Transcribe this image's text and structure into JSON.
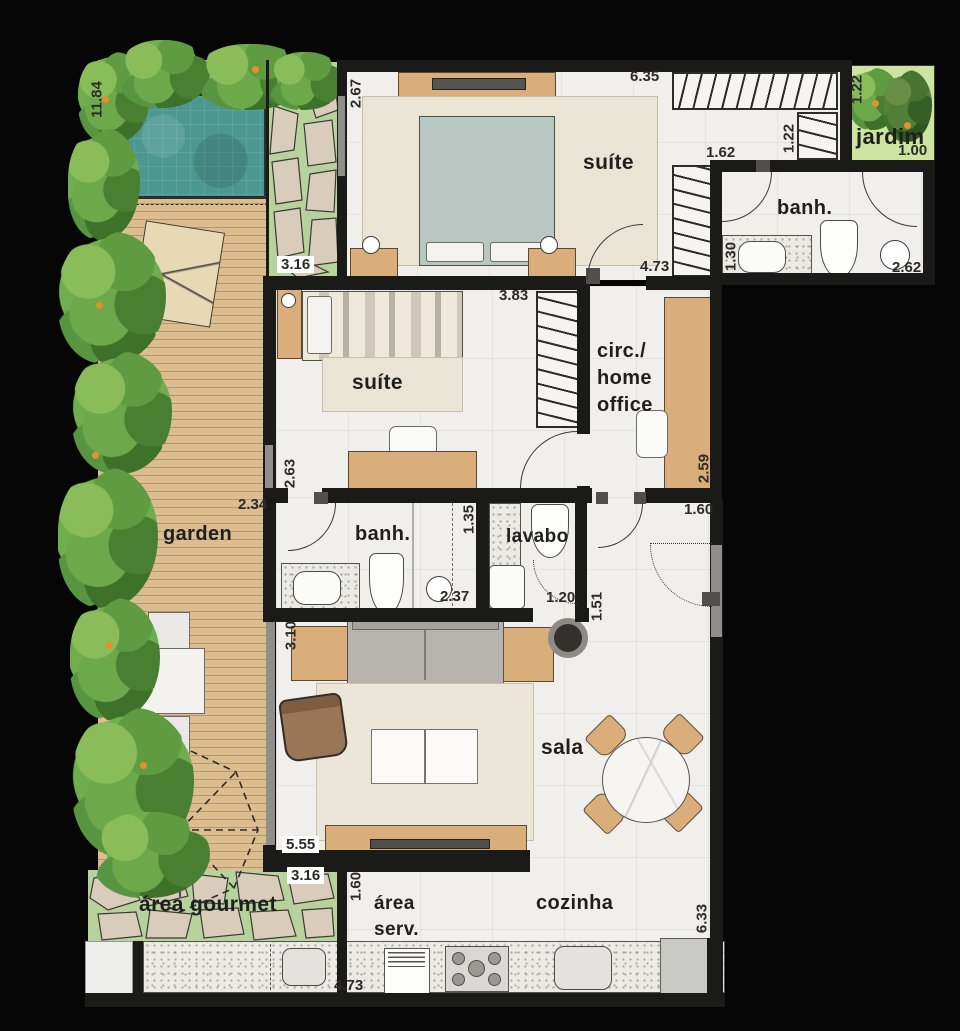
{
  "title": "Apartment floor plan",
  "colors": {
    "background": "#060606",
    "wall": "#1a1a18",
    "floor": "#f0efeb",
    "wood_deck": "#dcbd90",
    "pool_water": "#4c9792",
    "vegetation": "#6fae4e",
    "stone_joint_green": "#b7d29d",
    "stone": "#d9ccba",
    "furniture_wood": "#d9ae7b",
    "rug": "#eae4d5",
    "text": "#1f1f1d"
  },
  "labels": {
    "jardim": "jardim",
    "suite_top": "suíte",
    "banh_top": "banh.",
    "suite_mid": "suíte",
    "circ_line1": "circ./",
    "circ_line2": "home",
    "circ_line3": "office",
    "garden": "garden",
    "banh_mid": "banh.",
    "lavabo": "lavabo",
    "sala": "sala",
    "area_gourmet": "área gourmet",
    "area_serv_line1": "área",
    "area_serv_line2": "serv.",
    "cozinha": "cozinha"
  },
  "dims": [
    "11.84",
    "2.67",
    "6.35",
    "1.22",
    "1.00",
    "1.62",
    "1.22",
    "3.16",
    "4.73",
    "1.30",
    "2.62",
    "3.83",
    "2.63",
    "2.59",
    "2.34",
    "1.35",
    "1.60",
    "2.37",
    "1.20",
    "1.51",
    "3.10",
    "5.55",
    "3.16",
    "1.60",
    "4.73",
    "6.33"
  ]
}
